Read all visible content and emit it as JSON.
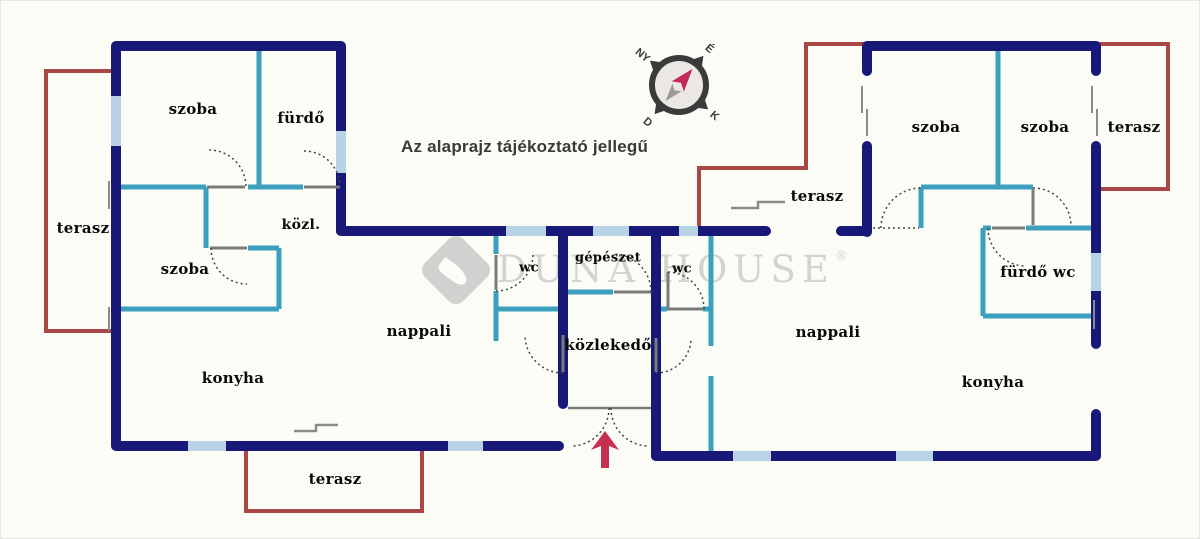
{
  "note": {
    "text": "Az alaprajz tájékoztató jellegű"
  },
  "watermark": {
    "brand": "DUNA HOUSE",
    "registered": "®"
  },
  "compass": {
    "north": "É",
    "south": "D",
    "east": "K",
    "west": "NY"
  },
  "rooms": {
    "szoba_top_left": "szoba",
    "furdo": "fürdő",
    "kozl": "közl.",
    "szoba_lower_left": "szoba",
    "terasz_left": "terasz",
    "nappali_left": "nappali",
    "konyha_left": "konyha",
    "terasz_bottom": "terasz",
    "wc_left": "wc",
    "gepeszet": "gépészet",
    "kozlekedo": "közlekedő",
    "wc_right": "wc",
    "terasz_middle": "terasz",
    "szoba_right_1": "szoba",
    "szoba_right_2": "szoba",
    "terasz_top_right": "terasz",
    "furdo_wc": "fürdő wc",
    "nappali_right": "nappali",
    "konyha_right": "konyha"
  },
  "colors": {
    "exterior_wall": "#181878",
    "partition_wall": "#3d9fbe",
    "window": "#b9d3e6",
    "terrace_outline": "#a84743",
    "entrance_arrow": "#c53050",
    "door_arc": "#444444",
    "watermark_gray": "#c6c6c6"
  }
}
